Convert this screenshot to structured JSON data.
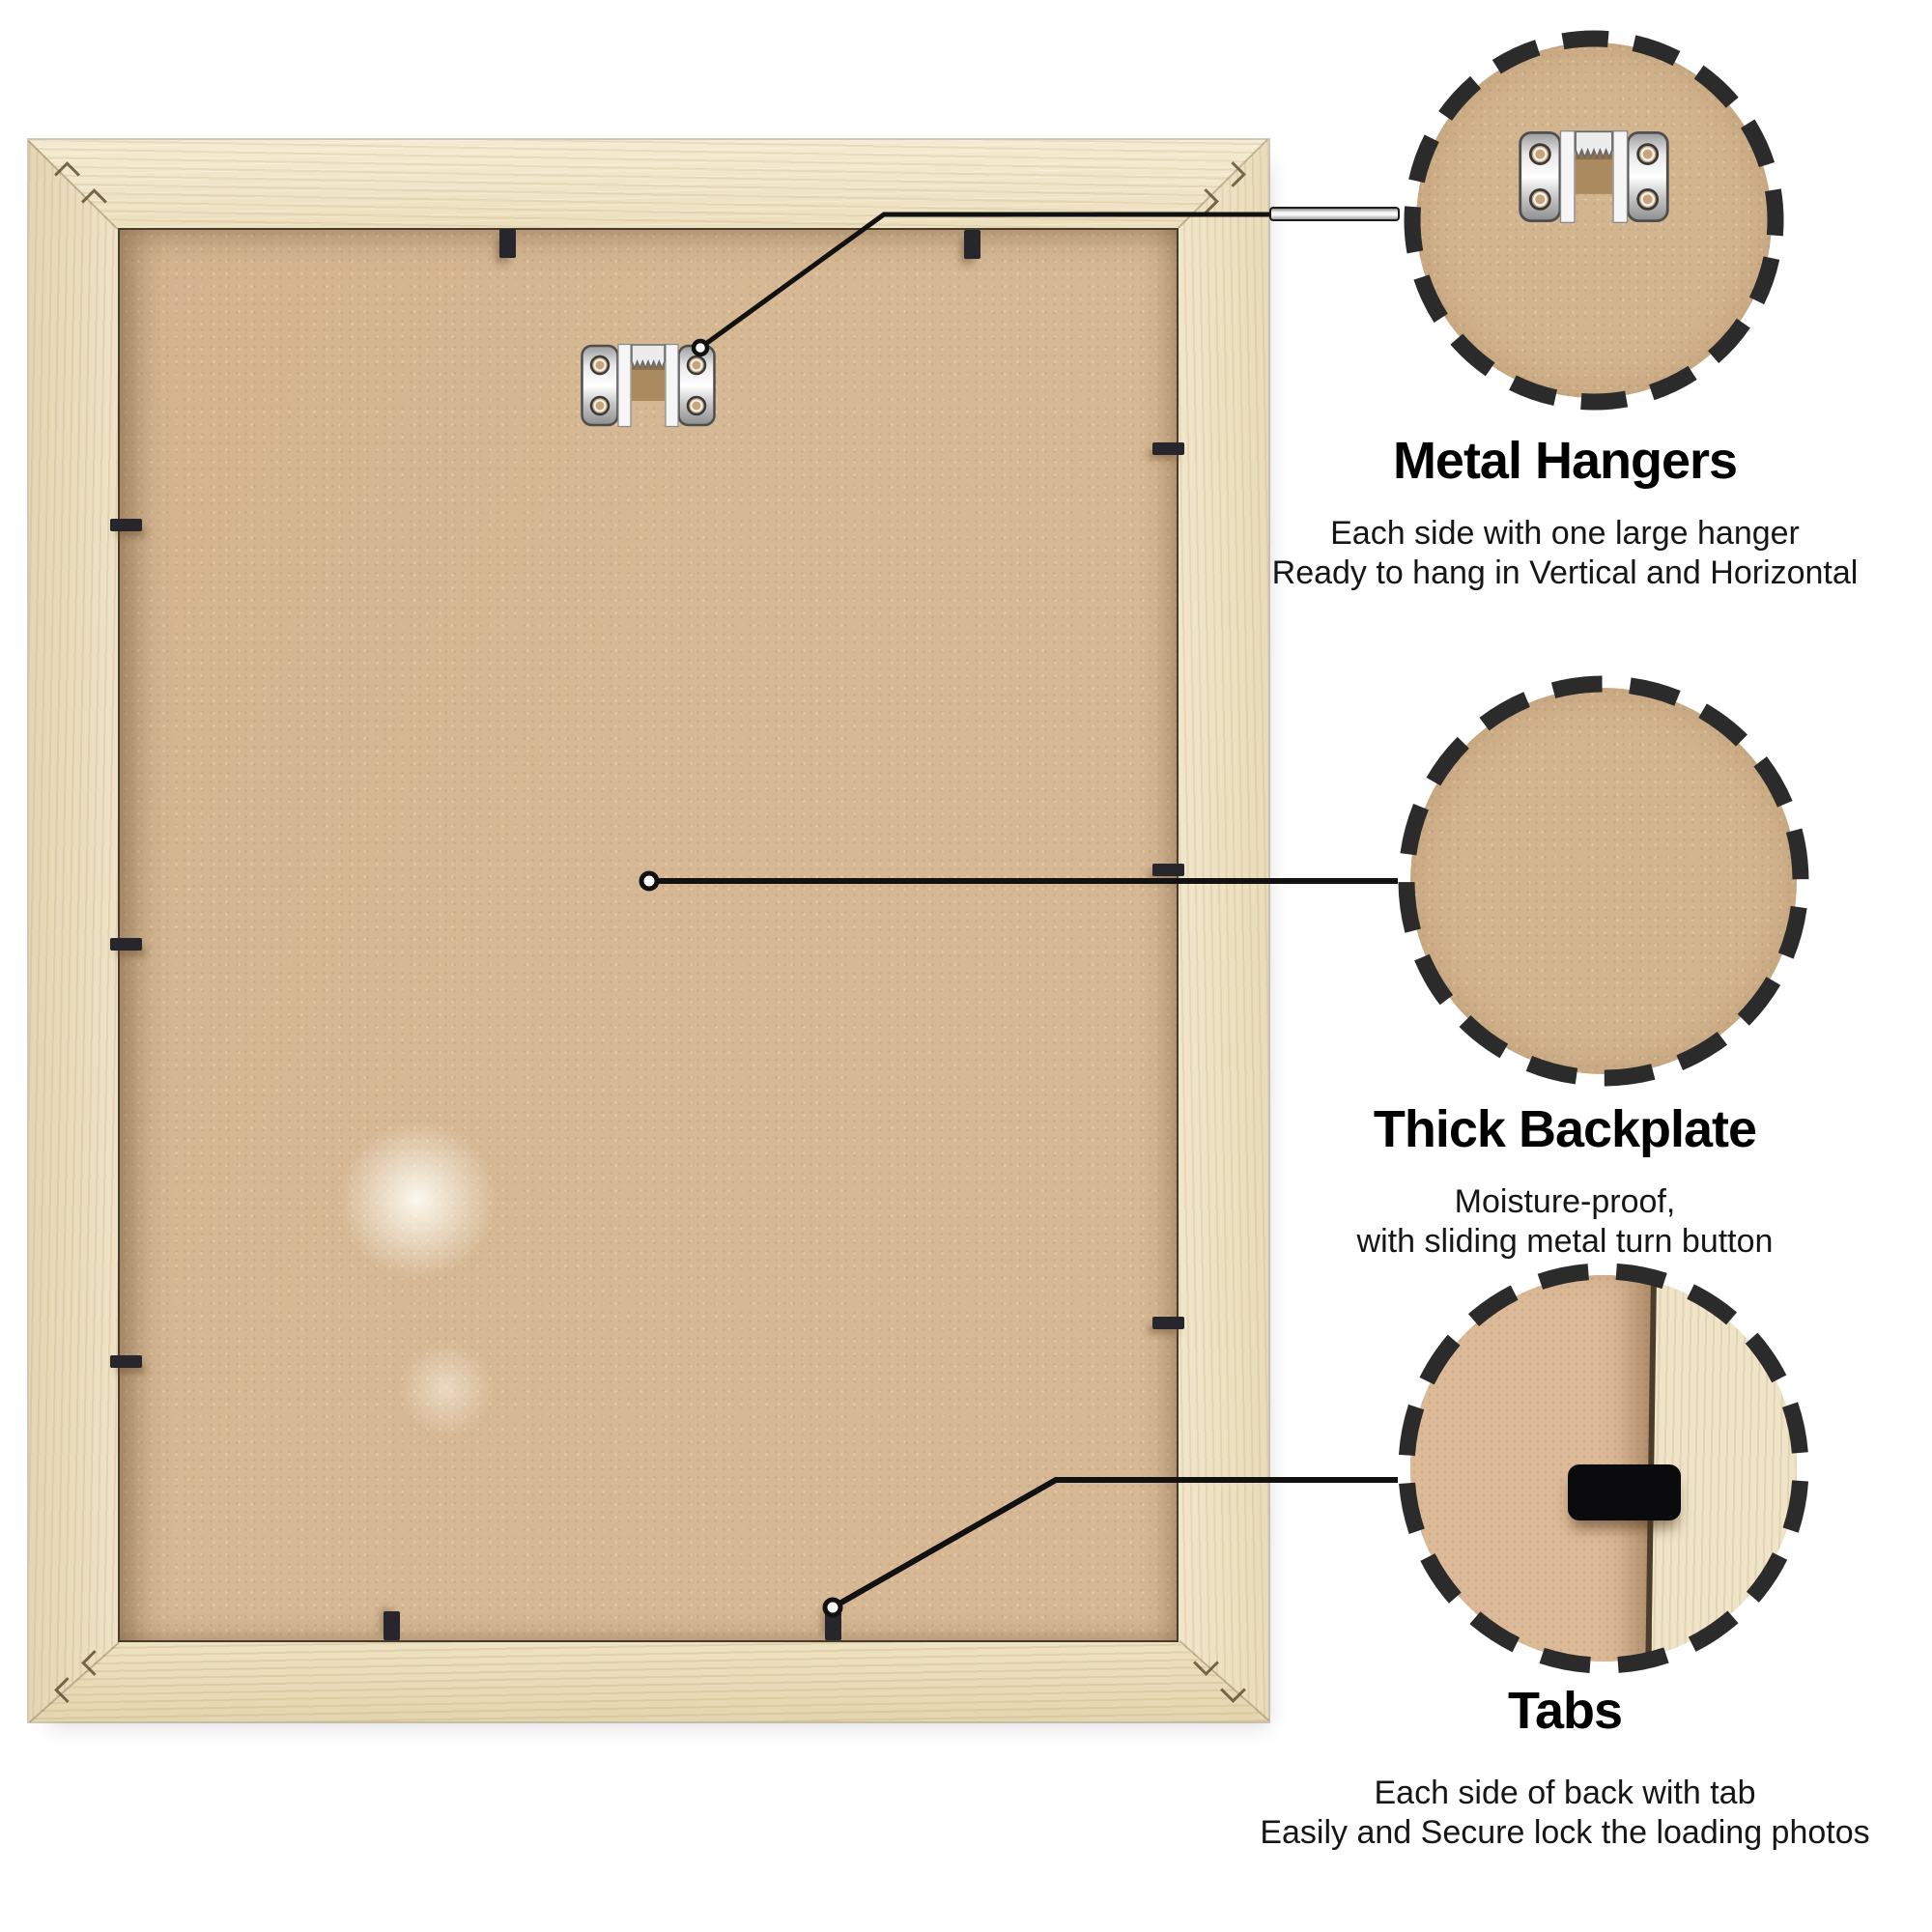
{
  "callouts": [
    {
      "title": "Metal Hangers",
      "desc_line1": "Each side with one large hanger",
      "desc_line2": "Ready to hang in Vertical and Horizontal"
    },
    {
      "title": "Thick Backplate",
      "desc_line1": "Moisture-proof,",
      "desc_line2": "with sliding metal turn button"
    },
    {
      "title": "Tabs",
      "desc_line1": "Each side of back with tab",
      "desc_line2": "Easily and Secure lock the loading photos"
    }
  ],
  "colors": {
    "background": "#ffffff",
    "wood": "#ece0c3",
    "backplate": "#d6b894",
    "tab": "#26262c",
    "leader_line": "#111111",
    "circle_dash": "#2b2b2b",
    "title_text": "#000000",
    "desc_text": "#161616"
  }
}
